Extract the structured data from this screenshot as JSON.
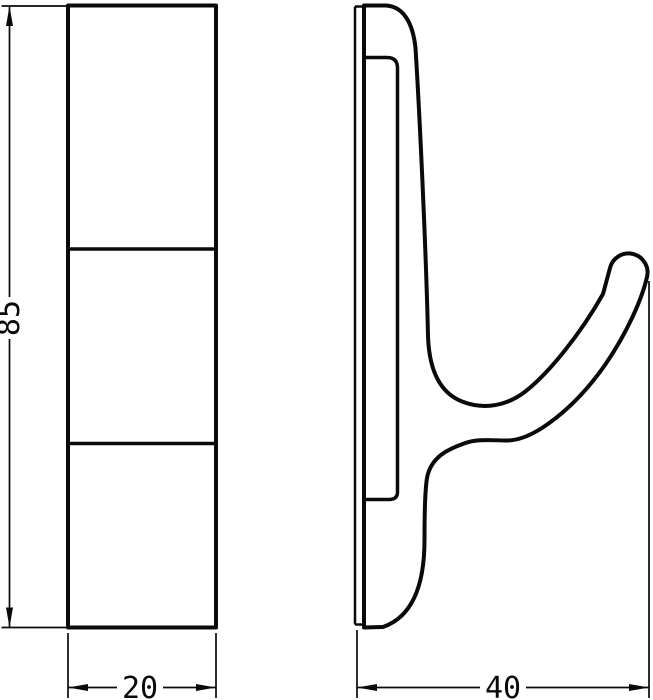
{
  "drawing": {
    "kind": "technical-dimension-drawing",
    "subject": "wall hook, two orthographic views",
    "colors": {
      "line": "#0a0a0a",
      "background": "#ffffff"
    },
    "views": {
      "front": {
        "name": "front-view",
        "segments": 3
      },
      "side": {
        "name": "side-profile-view"
      }
    },
    "dimensions": {
      "height": "85",
      "width": "20",
      "depth": "40"
    }
  }
}
